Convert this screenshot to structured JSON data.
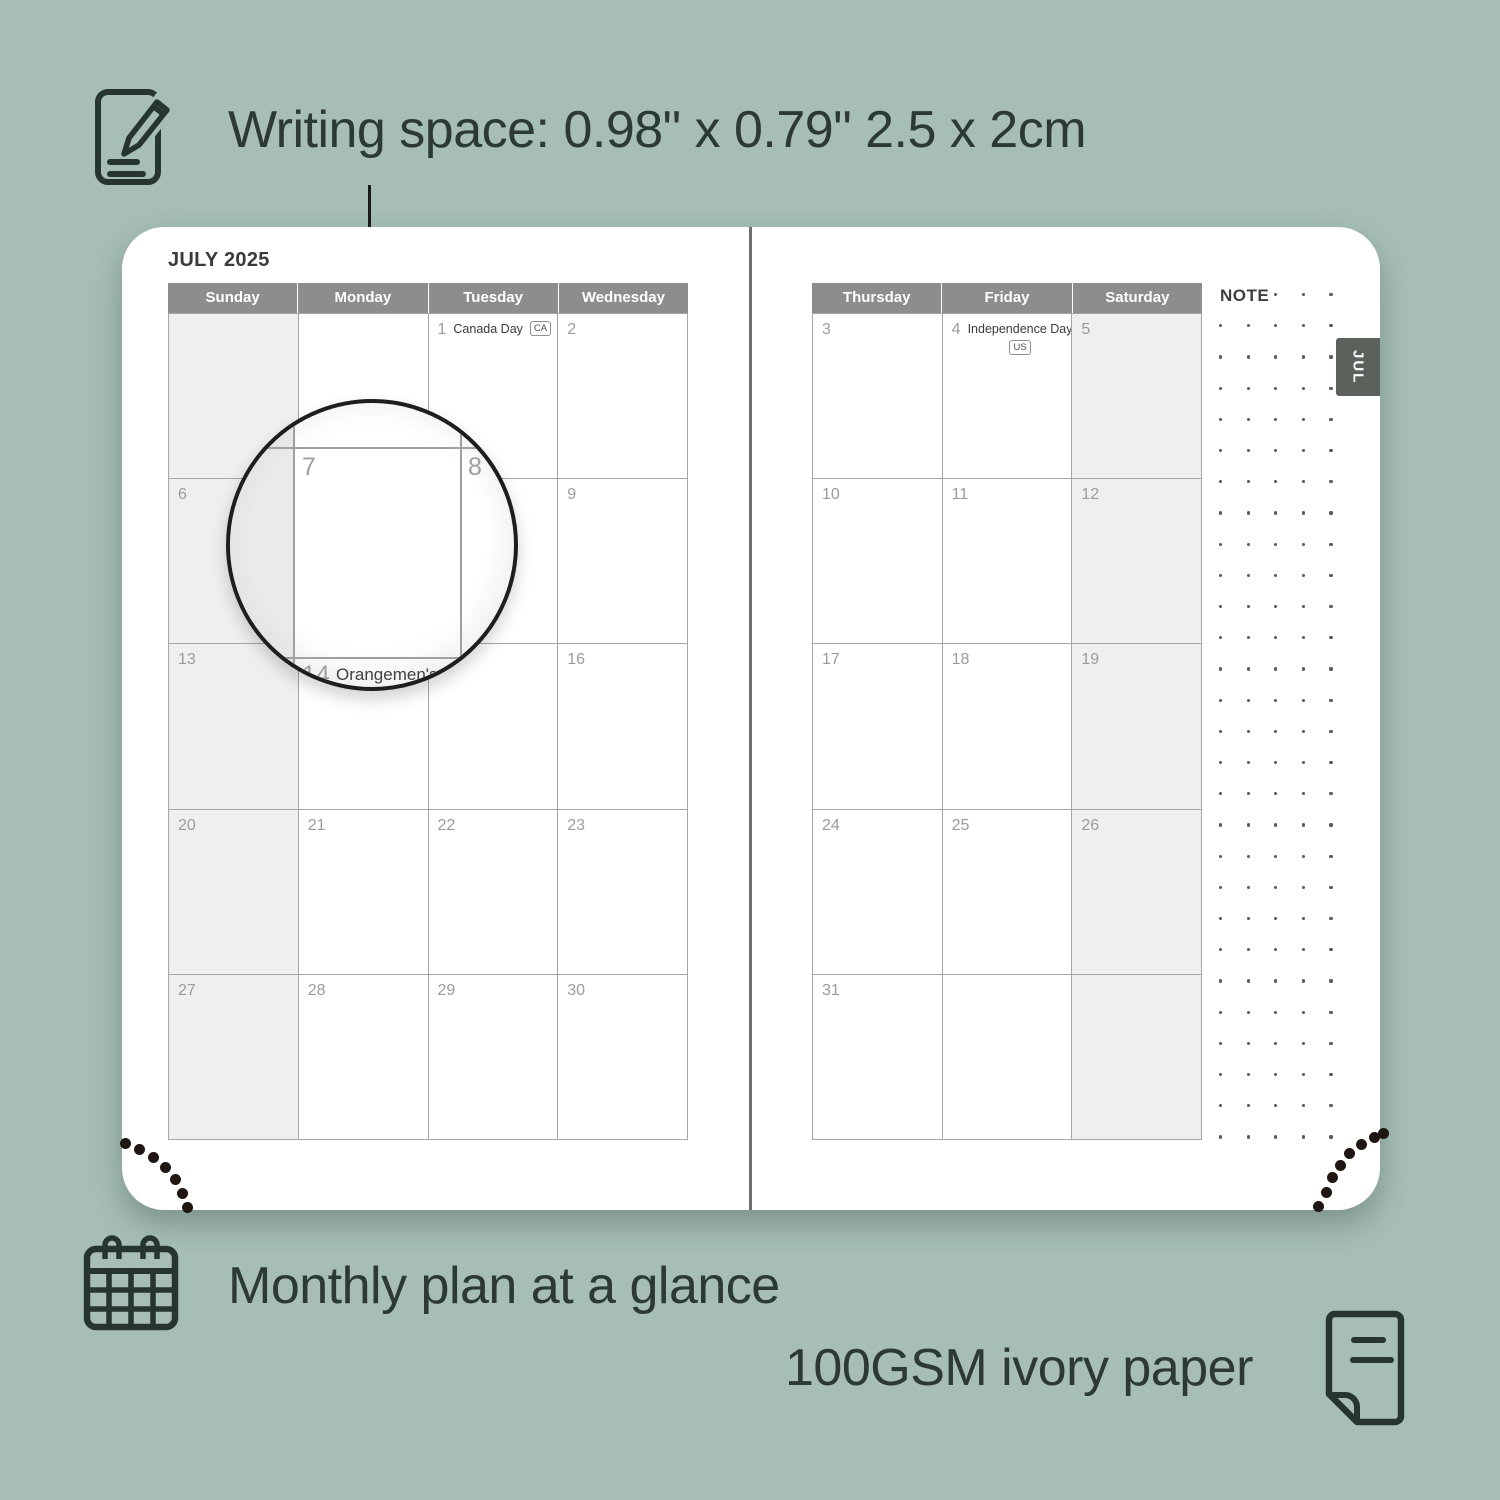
{
  "annotations": {
    "writing_space": "Writing space: 0.98\" x 0.79\" 2.5 x 2cm",
    "monthly_plan": "Monthly plan at a glance",
    "paper": "100GSM ivory paper"
  },
  "planner": {
    "month_title": "JULY 2025",
    "tab_label": "JUL",
    "note_label": "NOTE",
    "left_day_headers": [
      "Sunday",
      "Monday",
      "Tuesday",
      "Wednesday"
    ],
    "right_day_headers": [
      "Thursday",
      "Friday",
      "Saturday"
    ],
    "left_weekend_columns": [
      0
    ],
    "right_weekend_columns": [
      2
    ],
    "left_weeks": [
      [
        {
          "d": ""
        },
        {
          "d": ""
        },
        {
          "d": "1",
          "holiday": "Canada Day",
          "badge": "CA"
        },
        {
          "d": "2"
        }
      ],
      [
        {
          "d": "6"
        },
        {
          "d": "7"
        },
        {
          "d": "8"
        },
        {
          "d": "9"
        }
      ],
      [
        {
          "d": "13"
        },
        {
          "d": "14"
        },
        {
          "d": "15"
        },
        {
          "d": "16"
        }
      ],
      [
        {
          "d": "20"
        },
        {
          "d": "21"
        },
        {
          "d": "22"
        },
        {
          "d": "23"
        }
      ],
      [
        {
          "d": "27"
        },
        {
          "d": "28"
        },
        {
          "d": "29"
        },
        {
          "d": "30"
        }
      ]
    ],
    "right_weeks": [
      [
        {
          "d": "3"
        },
        {
          "d": "4",
          "holiday": "Independence Day",
          "badge": "US",
          "badge_below": true
        },
        {
          "d": "5"
        }
      ],
      [
        {
          "d": "10"
        },
        {
          "d": "11"
        },
        {
          "d": "12"
        }
      ],
      [
        {
          "d": "17"
        },
        {
          "d": "18"
        },
        {
          "d": "19"
        }
      ],
      [
        {
          "d": "24"
        },
        {
          "d": "25"
        },
        {
          "d": "26"
        }
      ],
      [
        {
          "d": "31"
        },
        {
          "d": ""
        },
        {
          "d": ""
        }
      ]
    ]
  },
  "magnifier": {
    "day_main": "7",
    "day_right": "8",
    "day_below": "14",
    "holiday_below": "Orangemen's D"
  },
  "colors": {
    "background": "#a6beb7",
    "header_gray": "#8d8d8d",
    "weekend_shade": "#efefef",
    "grid_line": "#a6a6a6",
    "date_gray": "#9b9b9b",
    "tab_gray": "#5b615b",
    "text_dark": "#2d3935",
    "stitch_dot": "#201612"
  }
}
